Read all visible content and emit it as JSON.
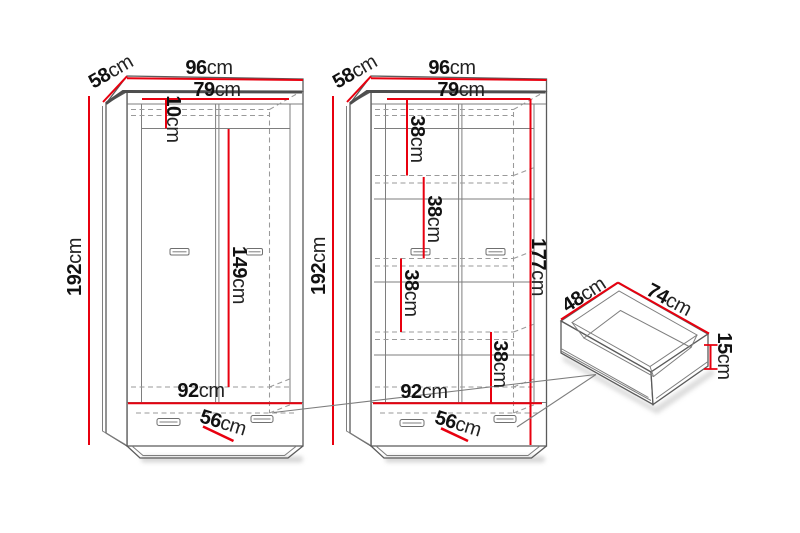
{
  "diagram": {
    "type": "furniture-dimension-diagram",
    "background_color": "#ffffff",
    "dimension_color": "#e8000f",
    "line_color": "#5b5b5b",
    "wardrobe_left": {
      "description": "two-door wardrobe with bottom drawer, front view (closed)",
      "width": {
        "value": "96",
        "unit": "cm"
      },
      "depth": {
        "value": "58",
        "unit": "cm"
      },
      "interior_width": {
        "value": "79",
        "unit": "cm"
      },
      "top_clearance": {
        "value": "10",
        "unit": "cm"
      },
      "height": {
        "value": "192",
        "unit": "cm"
      },
      "hanging_space_height": {
        "value": "149",
        "unit": "cm"
      },
      "interior_bottom_width": {
        "value": "92",
        "unit": "cm"
      },
      "drawer_width": {
        "value": "56",
        "unit": "cm"
      }
    },
    "wardrobe_right": {
      "description": "two-door wardrobe with shelves and bottom drawer, interior view",
      "width": {
        "value": "96",
        "unit": "cm"
      },
      "depth": {
        "value": "58",
        "unit": "cm"
      },
      "interior_width": {
        "value": "79",
        "unit": "cm"
      },
      "shelf_spacings": [
        {
          "value": "38",
          "unit": "cm"
        },
        {
          "value": "38",
          "unit": "cm"
        },
        {
          "value": "38",
          "unit": "cm"
        },
        {
          "value": "38",
          "unit": "cm"
        }
      ],
      "height": {
        "value": "192",
        "unit": "cm"
      },
      "interior_height": {
        "value": "177",
        "unit": "cm"
      },
      "interior_bottom_width": {
        "value": "92",
        "unit": "cm"
      },
      "drawer_width": {
        "value": "56",
        "unit": "cm"
      }
    },
    "drawer_box": {
      "description": "pull-out drawer box, isometric detail",
      "depth": {
        "value": "48",
        "unit": "cm"
      },
      "width": {
        "value": "74",
        "unit": "cm"
      },
      "height": {
        "value": "15",
        "unit": "cm"
      }
    }
  }
}
